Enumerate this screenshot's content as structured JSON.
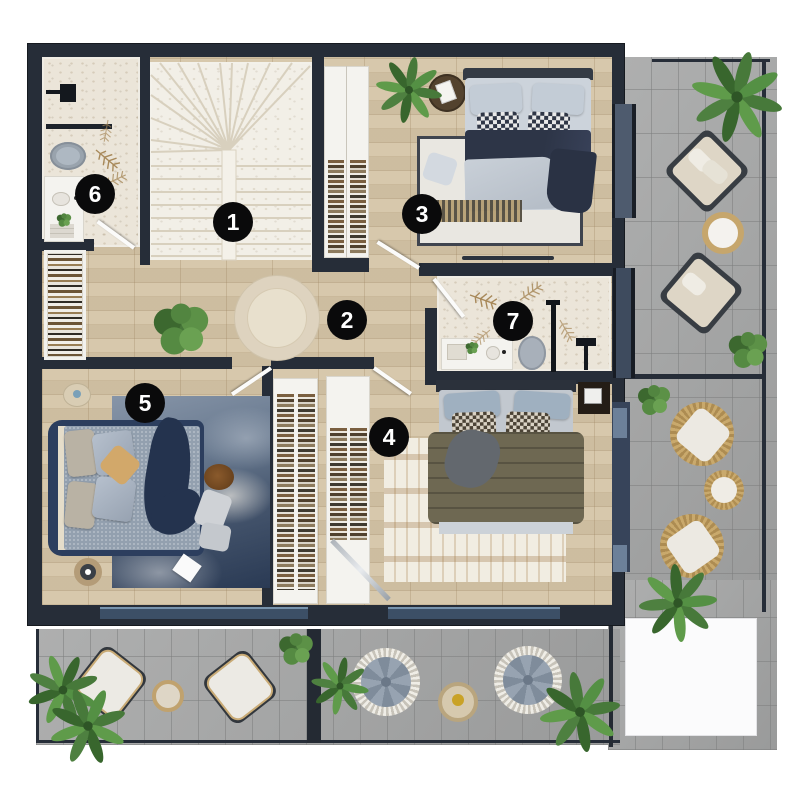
{
  "plan": {
    "type": "floor-plan",
    "rooms": [
      {
        "number": "1",
        "name": "staircase",
        "x": 233,
        "y": 222
      },
      {
        "number": "2",
        "name": "hallway-landing",
        "x": 347,
        "y": 320
      },
      {
        "number": "3",
        "name": "bedroom",
        "x": 422,
        "y": 214
      },
      {
        "number": "4",
        "name": "bedroom-with-walkin-closet",
        "x": 389,
        "y": 437
      },
      {
        "number": "5",
        "name": "master-bedroom",
        "x": 145,
        "y": 403
      },
      {
        "number": "6",
        "name": "bathroom",
        "x": 95,
        "y": 194
      },
      {
        "number": "7",
        "name": "bathroom",
        "x": 513,
        "y": 321
      }
    ],
    "colors": {
      "wall": "#262d38",
      "wood_floor": "#d5c5a7",
      "stone_floor": "#ebe5d9",
      "terrace_tile": "#a5a6a6",
      "window_glass": "#4e5b6e",
      "accent_navy": "#2c3e5e",
      "wicker": "#c9a96c",
      "plant_green": "#4e8040",
      "marker_bg": "#0a0a0b",
      "marker_text": "#ffffff"
    }
  }
}
